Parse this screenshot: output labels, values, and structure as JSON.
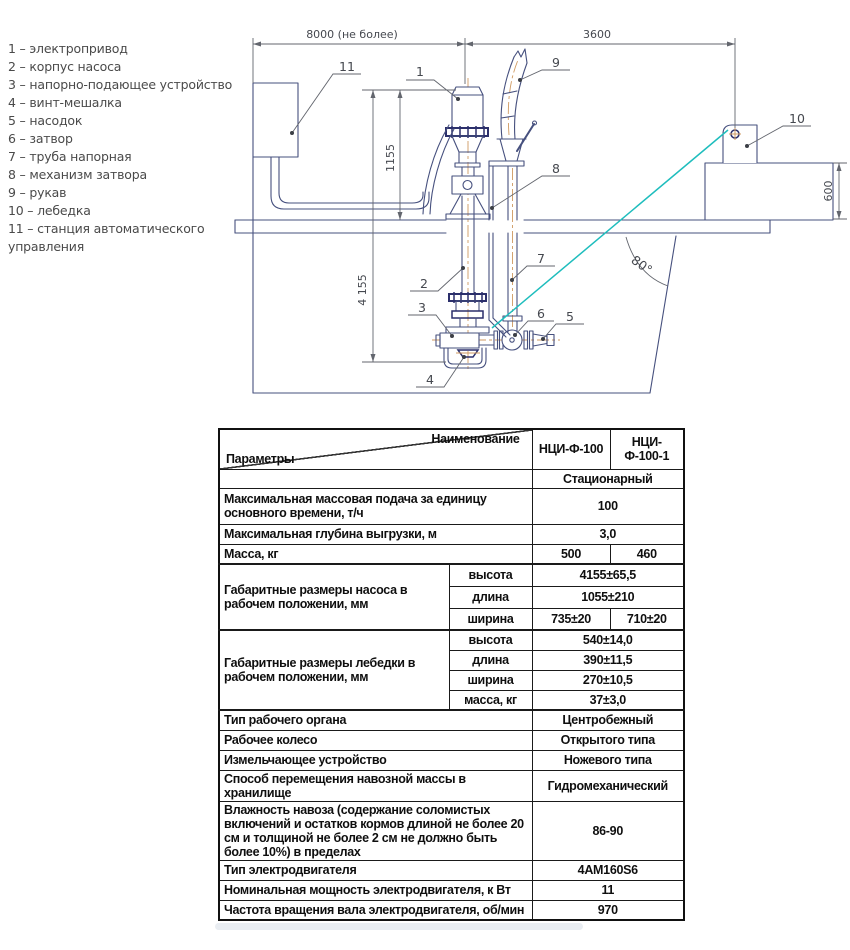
{
  "legend": {
    "separator": "–",
    "items": [
      {
        "num": "1",
        "label": "электропривод"
      },
      {
        "num": "2",
        "label": "корпус насоса"
      },
      {
        "num": "3",
        "label": "напорно-подающее устройство"
      },
      {
        "num": "4",
        "label": "винт-мешалка"
      },
      {
        "num": "5",
        "label": "насодок"
      },
      {
        "num": "6",
        "label": "затвор"
      },
      {
        "num": "7",
        "label": "труба напорная"
      },
      {
        "num": "8",
        "label": "механизм затвора"
      },
      {
        "num": "9",
        "label": "рукав"
      },
      {
        "num": "10",
        "label": "лебедка"
      },
      {
        "num": "11",
        "label": "станция автоматического управления"
      }
    ]
  },
  "drawing": {
    "dimensions": {
      "overall_width": "8000 (не более)",
      "winch_offset": "3600",
      "pump_above_floor": "1155",
      "pump_total_height": "4 155",
      "pedestal_height": "600",
      "wall_angle": "80°"
    },
    "colors": {
      "line": "#46507e",
      "flange_navy": "#2b2f6b",
      "centerline_orange": "#cf9a62",
      "cable_cyan": "#1ebdbd",
      "annotation_gray": "#63666e"
    }
  },
  "table": {
    "corner": {
      "top": "Наименование",
      "bottom": "Параметры"
    },
    "columns": [
      "НЦИ-Ф-100",
      "НЦИ-Ф-100-1"
    ],
    "type_row": {
      "value": "Стационарный"
    },
    "rows": {
      "feed": {
        "param": "Максимальная массовая подача за единицу основного времени, т/ч",
        "value": "100"
      },
      "depth": {
        "param": "Максимальная глубина выгрузки, м",
        "value": "3,0"
      },
      "mass": {
        "param": "Масса, кг",
        "v1": "500",
        "v2": "460"
      },
      "pump_dims": {
        "param": "Габаритные размеры насоса в рабочем положении, мм",
        "height": {
          "label": "высота",
          "value": "4155±65,5"
        },
        "length": {
          "label": "длина",
          "value": "1055±210"
        },
        "width": {
          "label": "ширина",
          "v1": "735±20",
          "v2": "710±20"
        }
      },
      "winch_dims": {
        "param": "Габаритные размеры лебедки в рабочем положении, мм",
        "height": {
          "label": "высота",
          "value": "540±14,0"
        },
        "length": {
          "label": "длина",
          "value": "390±11,5"
        },
        "width": {
          "label": "ширина",
          "value": "270±10,5"
        },
        "mass": {
          "label": "масса, кг",
          "value": "37±3,0"
        }
      },
      "organ": {
        "param": "Тип рабочего органа",
        "value": "Центробежный"
      },
      "wheel": {
        "param": "Рабочее колесо",
        "value": "Открытого типа"
      },
      "shredder": {
        "param": "Измельчающее устройство",
        "value": "Ножевого типа"
      },
      "method": {
        "param": "Способ перемещения навозной массы в хранилище",
        "value": "Гидромеханический"
      },
      "humidity": {
        "param": "Влажность навоза (содержание соломистых включений и остатков кормов длиной не более 20 см и толщиной не более 2 см не должно быть более 10%) в пределах",
        "value": "86-90"
      },
      "motor_type": {
        "param": "Тип электродвигателя",
        "value": "4АМ160S6"
      },
      "power": {
        "param": "Номинальная мощность электродвигателя, к Вт",
        "value": "11"
      },
      "rpm": {
        "param": "Частота вращения вала электродвигателя, об/мин",
        "value": "970"
      }
    }
  }
}
